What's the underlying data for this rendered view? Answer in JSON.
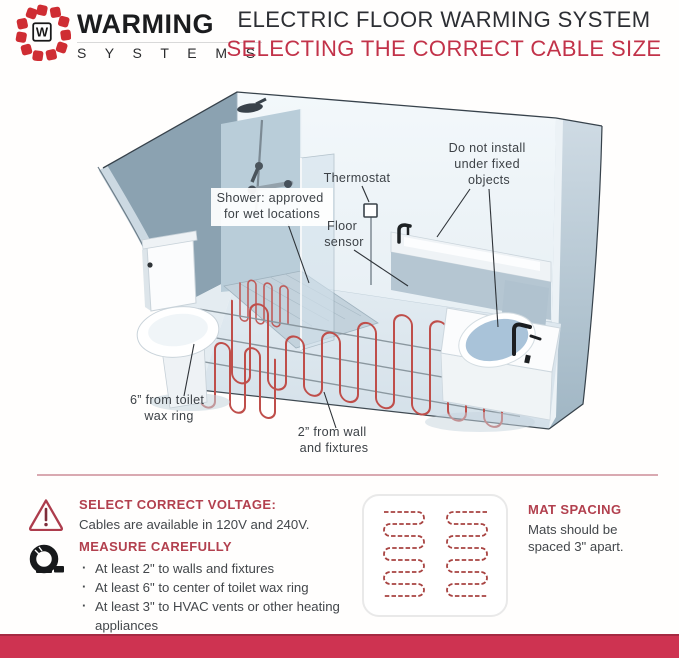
{
  "header": {
    "brand": {
      "monogram": "W",
      "name": "WARMING",
      "sub": "S Y S T E M S"
    },
    "title": "ELECTRIC FLOOR WARMING SYSTEM",
    "subtitle": "SELECTING THE CORRECT CABLE SIZE"
  },
  "diagram": {
    "labels": {
      "shower": [
        "Shower: approved",
        "for wet locations"
      ],
      "thermostat": "Thermostat",
      "floor_sensor": [
        "Floor",
        "sensor"
      ],
      "fixed_objects": [
        "Do not install",
        "under fixed",
        "objects"
      ],
      "toilet_clearance": [
        "6” from toilet",
        "wax ring"
      ],
      "wall_clearance": [
        "2” from wall",
        "and fixtures"
      ]
    }
  },
  "tips": {
    "voltage": {
      "heading": "SELECT CORRECT VOLTAGE:",
      "body": "Cables are available in 120V and 240V."
    },
    "measure": {
      "heading": "MEASURE CAREFULLY",
      "bullets": [
        "At least 2\" to walls and fixtures",
        "At least 6\" to center of toilet wax ring",
        "At least 3\" to HVAC vents or other heating appliances"
      ]
    },
    "mat": {
      "heading": "MAT SPACING",
      "body": "Mats should be spaced 3\" apart."
    }
  },
  "icons": {
    "brand": "warming-systems-logo",
    "voltage": "warning-triangle-icon",
    "measure": "tape-measure-icon",
    "mat": "heating-mat-pattern"
  },
  "colors": {
    "accent_red": "#c23249",
    "heading_red": "#b2404e",
    "logo_red": "#cf2d33",
    "cable_red": "#bf4e4a",
    "footer_bar": "#ce3351",
    "wall_blue": "#b9cdd8",
    "floor_blue": "#dde7ee"
  }
}
